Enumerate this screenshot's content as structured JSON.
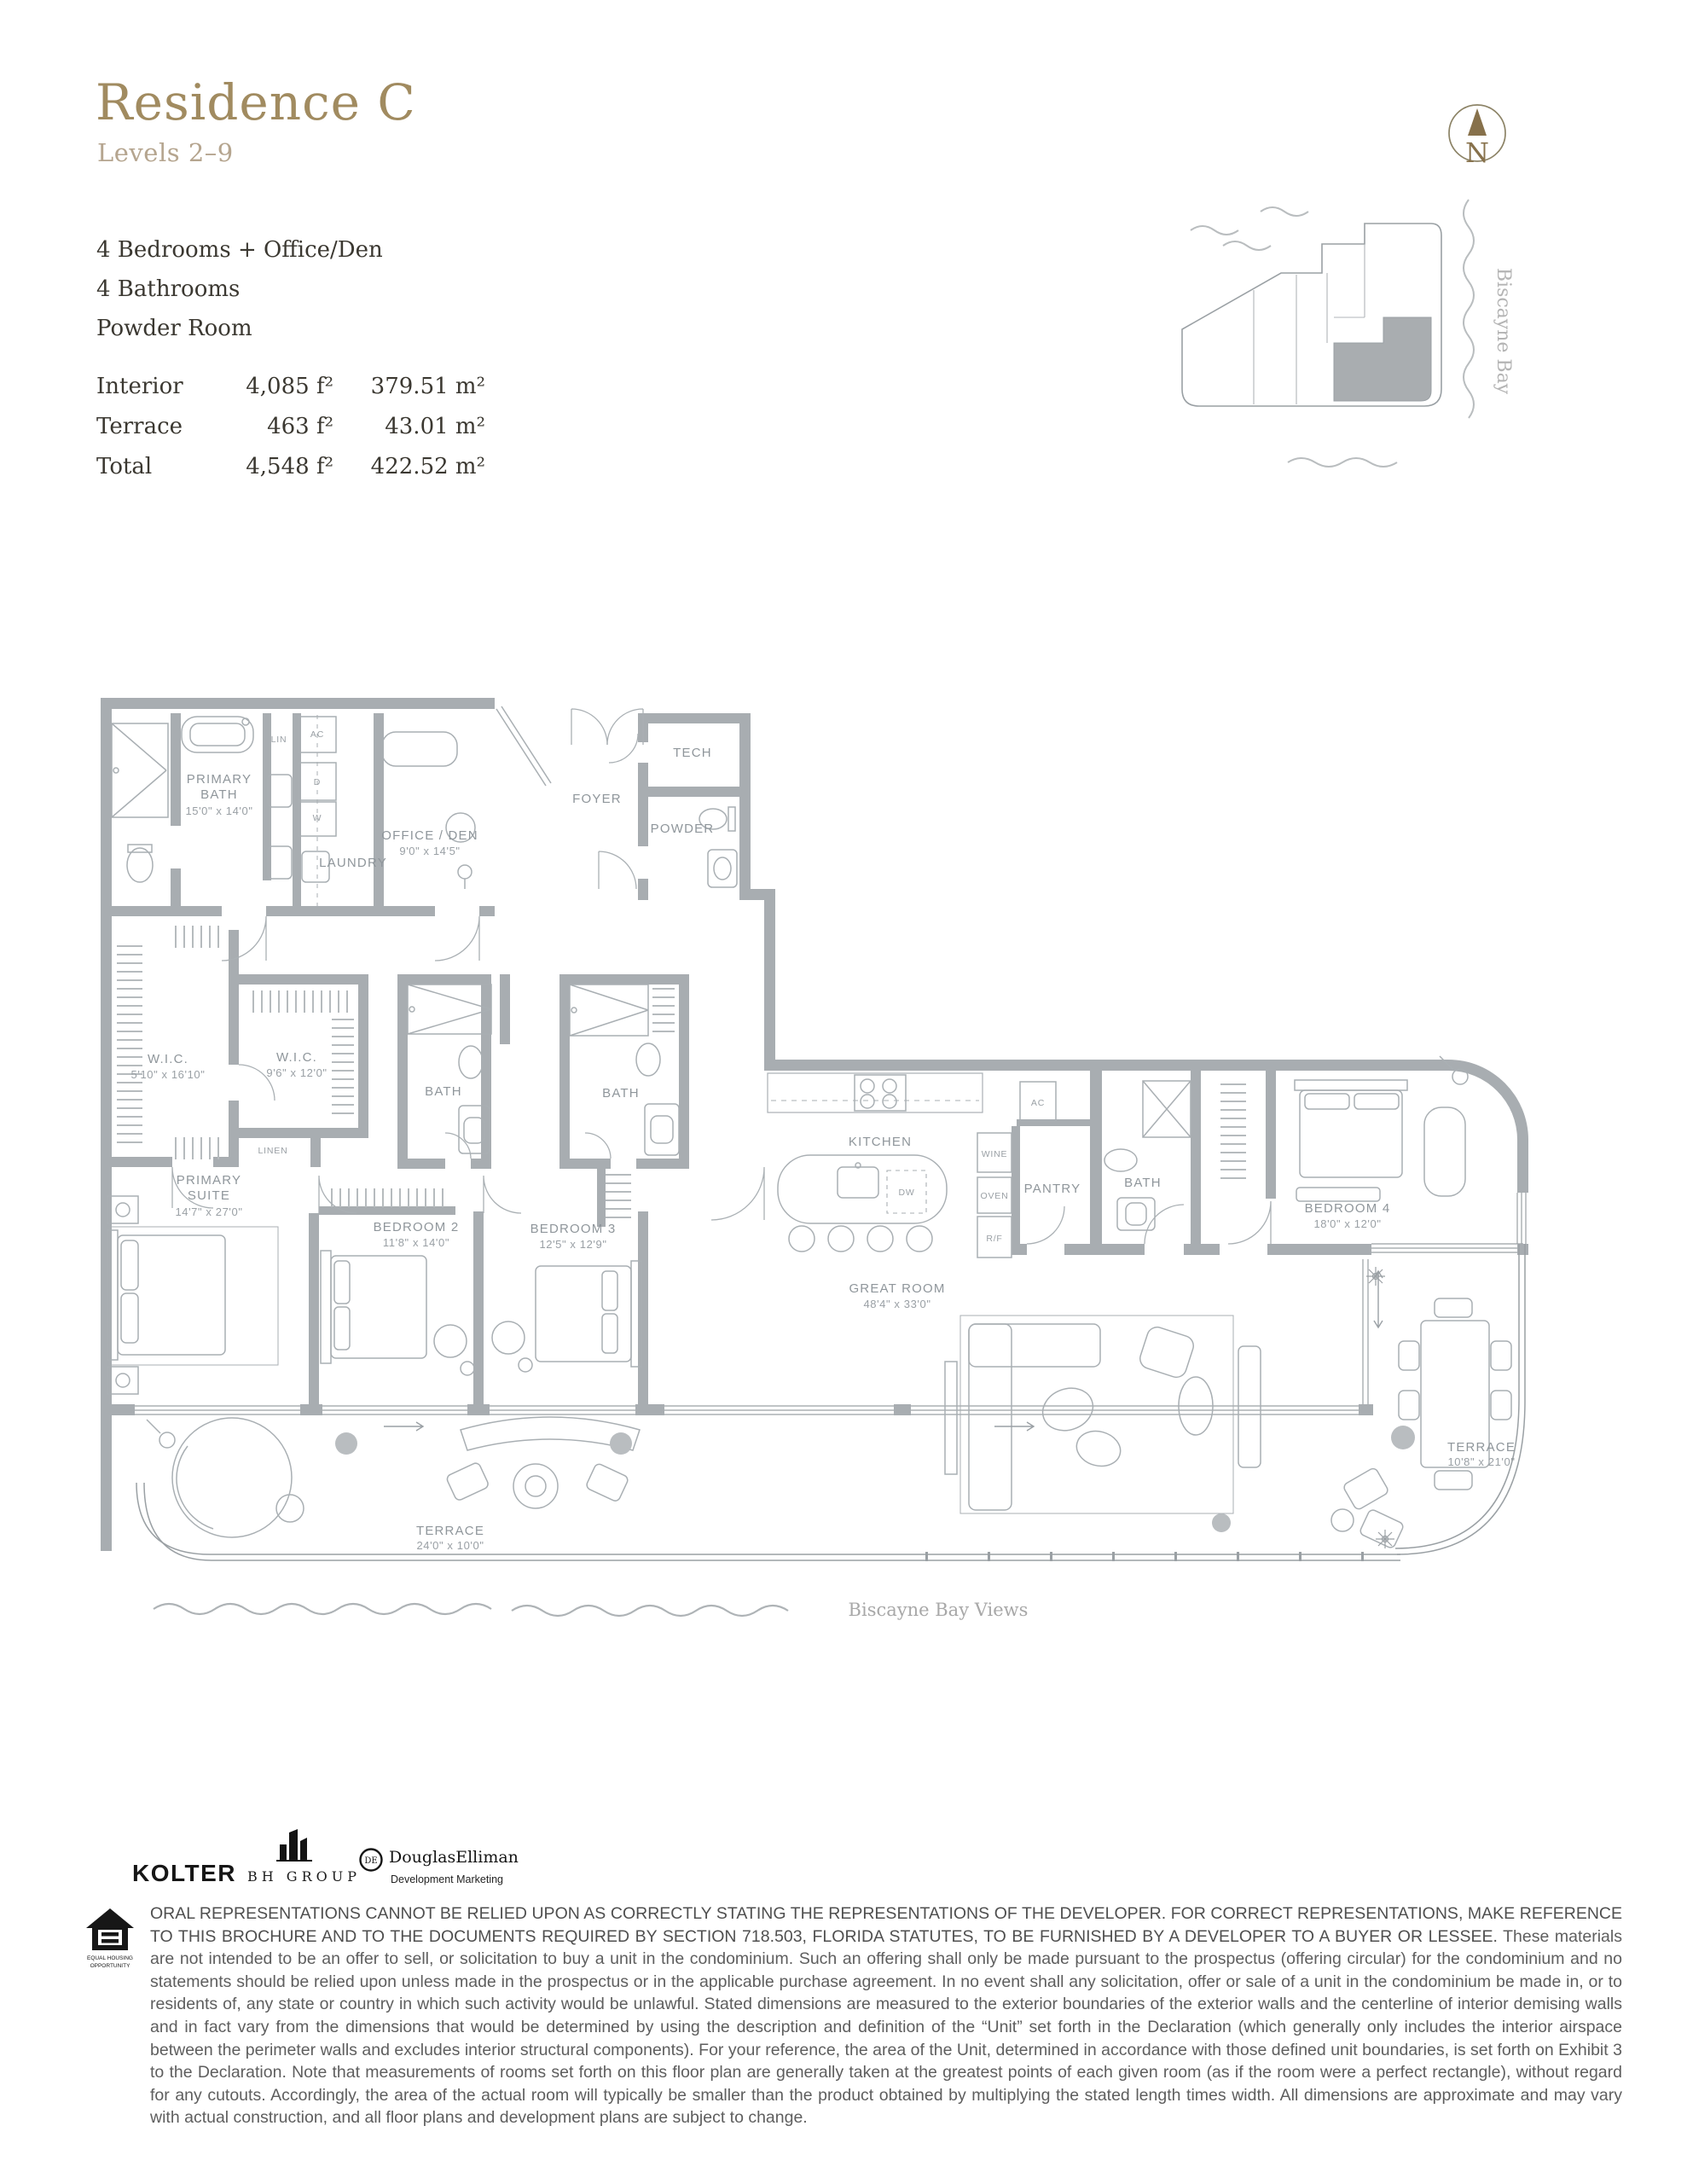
{
  "header": {
    "title": "Residence C",
    "subtitle": "Levels 2–9",
    "features": [
      "4 Bedrooms + Office/Den",
      "4 Bathrooms",
      "Powder Room"
    ],
    "areas": [
      {
        "label": "Interior",
        "imperial": "4,085 f²",
        "metric": "379.51 m²"
      },
      {
        "label": "Terrace",
        "imperial": "463 f²",
        "metric": "43.01 m²"
      },
      {
        "label": "Total",
        "imperial": "4,548 f²",
        "metric": "422.52 m²"
      }
    ]
  },
  "north": {
    "label": "N"
  },
  "keyplan": {
    "caption": "Biscayne Bay"
  },
  "plan": {
    "rooms": {
      "primary_bath": {
        "l1": "PRIMARY",
        "l2": "BATH",
        "dims": "15'0\" x 14'0\""
      },
      "lin": {
        "name": "LIN"
      },
      "ac": {
        "name": "AC"
      },
      "dryer": {
        "name": "D"
      },
      "washer": {
        "name": "W"
      },
      "laundry": {
        "name": "LAUNDRY"
      },
      "office_den": {
        "name": "OFFICE / DEN",
        "dims": "9'0\" x 14'5\""
      },
      "foyer": {
        "name": "FOYER"
      },
      "tech": {
        "name": "TECH"
      },
      "powder": {
        "name": "POWDER"
      },
      "wic1": {
        "name": "W.I.C.",
        "dims": "5'10\" x 16'10\""
      },
      "wic2": {
        "name": "W.I.C.",
        "dims": "9'6\" x 12'0\""
      },
      "linen": {
        "name": "LINEN"
      },
      "bath2": {
        "name": "BATH"
      },
      "bath3": {
        "name": "BATH"
      },
      "bath4": {
        "name": "BATH"
      },
      "primary_suite": {
        "l1": "PRIMARY",
        "l2": "SUITE",
        "dims": "14'7\" x 27'0\""
      },
      "bedroom2": {
        "name": "BEDROOM 2",
        "dims": "11'8\" x 14'0\""
      },
      "bedroom3": {
        "name": "BEDROOM 3",
        "dims": "12'5\" x 12'9\""
      },
      "bedroom4": {
        "name": "BEDROOM 4",
        "dims": "18'0\" x 12'0\""
      },
      "kitchen": {
        "name": "KITCHEN"
      },
      "pantry": {
        "name": "PANTRY"
      },
      "wine": {
        "name": "WINE"
      },
      "oven": {
        "name": "OVEN"
      },
      "fridge": {
        "name": "R/F"
      },
      "dw": {
        "name": "DW"
      },
      "great_room": {
        "name": "GREAT ROOM",
        "dims": "48'4\" x 33'0\""
      },
      "terrace_south": {
        "name": "TERRACE",
        "dims": "24'0\" x 10'0\""
      },
      "terrace_east": {
        "name": "TERRACE",
        "dims": "10'8\" x 21'0\""
      }
    },
    "annotations": {
      "bay_views": "Biscayne Bay Views"
    }
  },
  "logos": {
    "kolter": "KOLTER",
    "bh_group": "BH GROUP",
    "elliman": "DouglasElliman",
    "elliman_sub": "Development Marketing",
    "eho1": "EQUAL HOUSING",
    "eho2": "OPPORTUNITY"
  },
  "legal": {
    "caps": "ORAL REPRESENTATIONS CANNOT BE RELIED UPON AS CORRECTLY STATING THE REPRESENTATIONS OF THE DEVELOPER. FOR CORRECT REPRESENTATIONS, MAKE REFERENCE TO THIS BROCHURE AND TO THE DOCUMENTS REQUIRED BY SECTION 718.503, FLORIDA STATUTES, TO BE FURNISHED BY A DEVELOPER TO A BUYER OR LESSEE.",
    "body": "These materials are not intended to be an offer to sell, or solicitation to buy a unit in the condominium. Such an offering shall only be made pursuant to the prospectus (offering circular) for the condominium and no statements should be relied upon unless made in the prospectus or in the applicable purchase agreement. In no event shall any solicitation, offer or sale of a unit in the condominium be made in, or to residents of, any state or country in which such activity would be unlawful. Stated dimensions are measured to the exterior boundaries of the exterior walls and the centerline of interior demising walls and in fact vary from the dimensions that would be determined by using the description and definition of the “Unit” set forth in the Declaration (which generally only includes the interior airspace between the perimeter walls and excludes interior structural components).  For your reference, the area of the Unit, determined in accordance with those defined unit boundaries, is set forth on Exhibit 3 to the Declaration.  Note that measurements of rooms set forth on this floor plan are generally taken at the greatest points of each given room (as if the room were a perfect rectangle), without regard for any cutouts.  Accordingly, the area of the actual room will typically be smaller than the product obtained by multiplying the stated length times width.  All dimensions are approximate and may vary with actual construction, and all floor plans and development plans are subject to change."
  },
  "colors": {
    "accent_gold": "#a18b60",
    "muted_gold": "#b5a58f",
    "wall_gray": "#a8adb1",
    "label_gray": "#8f969b",
    "unit_highlight": "#a9adb0",
    "text_dark": "#3b3831"
  }
}
